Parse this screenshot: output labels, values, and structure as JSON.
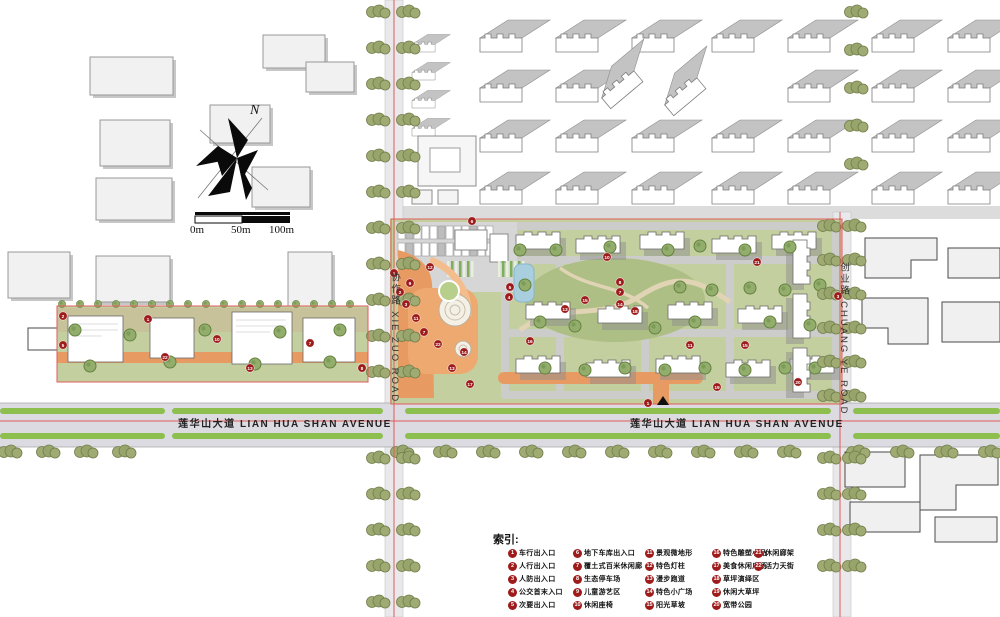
{
  "map": {
    "north_label": "N",
    "scale": {
      "t0": "0m",
      "t50": "50m",
      "t100": "100m"
    },
    "roads": {
      "xiezuo": "协作路 XIE ZUO ROAD",
      "chuangye": "创业路 CHUANG YE ROAD",
      "avenue_west": "莲华山大道 LIAN HUA SHAN AVENUE",
      "avenue_east": "莲华山大道 LIAN HUA SHAN AVENUE"
    },
    "markers": [
      {
        "n": 6,
        "x": 472,
        "y": 221
      },
      {
        "n": 1,
        "x": 394,
        "y": 273
      },
      {
        "n": 12,
        "x": 430,
        "y": 267
      },
      {
        "n": 9,
        "x": 410,
        "y": 283
      },
      {
        "n": 2,
        "x": 400,
        "y": 292
      },
      {
        "n": 3,
        "x": 406,
        "y": 304
      },
      {
        "n": 11,
        "x": 416,
        "y": 318
      },
      {
        "n": 7,
        "x": 424,
        "y": 332
      },
      {
        "n": 22,
        "x": 438,
        "y": 344
      },
      {
        "n": 14,
        "x": 464,
        "y": 352
      },
      {
        "n": 13,
        "x": 452,
        "y": 368
      },
      {
        "n": 17,
        "x": 470,
        "y": 384
      },
      {
        "n": 5,
        "x": 510,
        "y": 287
      },
      {
        "n": 4,
        "x": 509,
        "y": 297
      },
      {
        "n": 10,
        "x": 607,
        "y": 257
      },
      {
        "n": 8,
        "x": 620,
        "y": 282
      },
      {
        "n": 7,
        "x": 620,
        "y": 292
      },
      {
        "n": 15,
        "x": 585,
        "y": 300
      },
      {
        "n": 14,
        "x": 620,
        "y": 304
      },
      {
        "n": 13,
        "x": 565,
        "y": 309
      },
      {
        "n": 18,
        "x": 635,
        "y": 311
      },
      {
        "n": 16,
        "x": 530,
        "y": 341
      },
      {
        "n": 11,
        "x": 690,
        "y": 345
      },
      {
        "n": 15,
        "x": 745,
        "y": 345
      },
      {
        "n": 21,
        "x": 757,
        "y": 262
      },
      {
        "n": 19,
        "x": 717,
        "y": 387
      },
      {
        "n": 1,
        "x": 648,
        "y": 403
      },
      {
        "n": 20,
        "x": 798,
        "y": 382
      },
      {
        "n": 3,
        "x": 838,
        "y": 296
      },
      {
        "n": 2,
        "x": 63,
        "y": 316
      },
      {
        "n": 1,
        "x": 148,
        "y": 319
      },
      {
        "n": 10,
        "x": 217,
        "y": 339
      },
      {
        "n": 7,
        "x": 310,
        "y": 343
      },
      {
        "n": 22,
        "x": 165,
        "y": 357
      },
      {
        "n": 13,
        "x": 250,
        "y": 368
      },
      {
        "n": 8,
        "x": 362,
        "y": 368
      },
      {
        "n": 5,
        "x": 63,
        "y": 345
      }
    ]
  },
  "legend": {
    "title": "索引:",
    "columns": [
      [
        {
          "n": "1",
          "label": "车行出入口"
        },
        {
          "n": "2",
          "label": "人行出入口"
        },
        {
          "n": "3",
          "label": "人防出入口"
        },
        {
          "n": "4",
          "label": "公交首末入口"
        },
        {
          "n": "5",
          "label": "次要出入口"
        }
      ],
      [
        {
          "n": "6",
          "label": "地下车库出入口"
        },
        {
          "n": "7",
          "label": "覆土式百米休闲廊"
        },
        {
          "n": "8",
          "label": "生态停车场"
        },
        {
          "n": "9",
          "label": "儿童游艺区"
        },
        {
          "n": "10",
          "label": "休闲座椅"
        }
      ],
      [
        {
          "n": "11",
          "label": "景观微地形"
        },
        {
          "n": "12",
          "label": "特色灯柱"
        },
        {
          "n": "13",
          "label": "漫步跑道"
        },
        {
          "n": "14",
          "label": "特色小广场"
        },
        {
          "n": "15",
          "label": "阳光草坡"
        }
      ],
      [
        {
          "n": "16",
          "label": "特色雕塑小品"
        },
        {
          "n": "17",
          "label": "美食休闲广场"
        },
        {
          "n": "18",
          "label": "草坪演绎区"
        },
        {
          "n": "19",
          "label": "休闲大草坪"
        },
        {
          "n": "20",
          "label": "宽带公园"
        }
      ],
      [
        {
          "n": "21",
          "label": "休闲廊架"
        },
        {
          "n": "22",
          "label": "活力天街"
        }
      ]
    ]
  },
  "colors": {
    "marker_red": "#9e1b1b",
    "property_line": "#e05b5b",
    "median_green": "#8cbf4d",
    "path_orange": "#e79a62",
    "pond_blue": "#a9cede",
    "lawn_green": "#c3cf9f"
  }
}
